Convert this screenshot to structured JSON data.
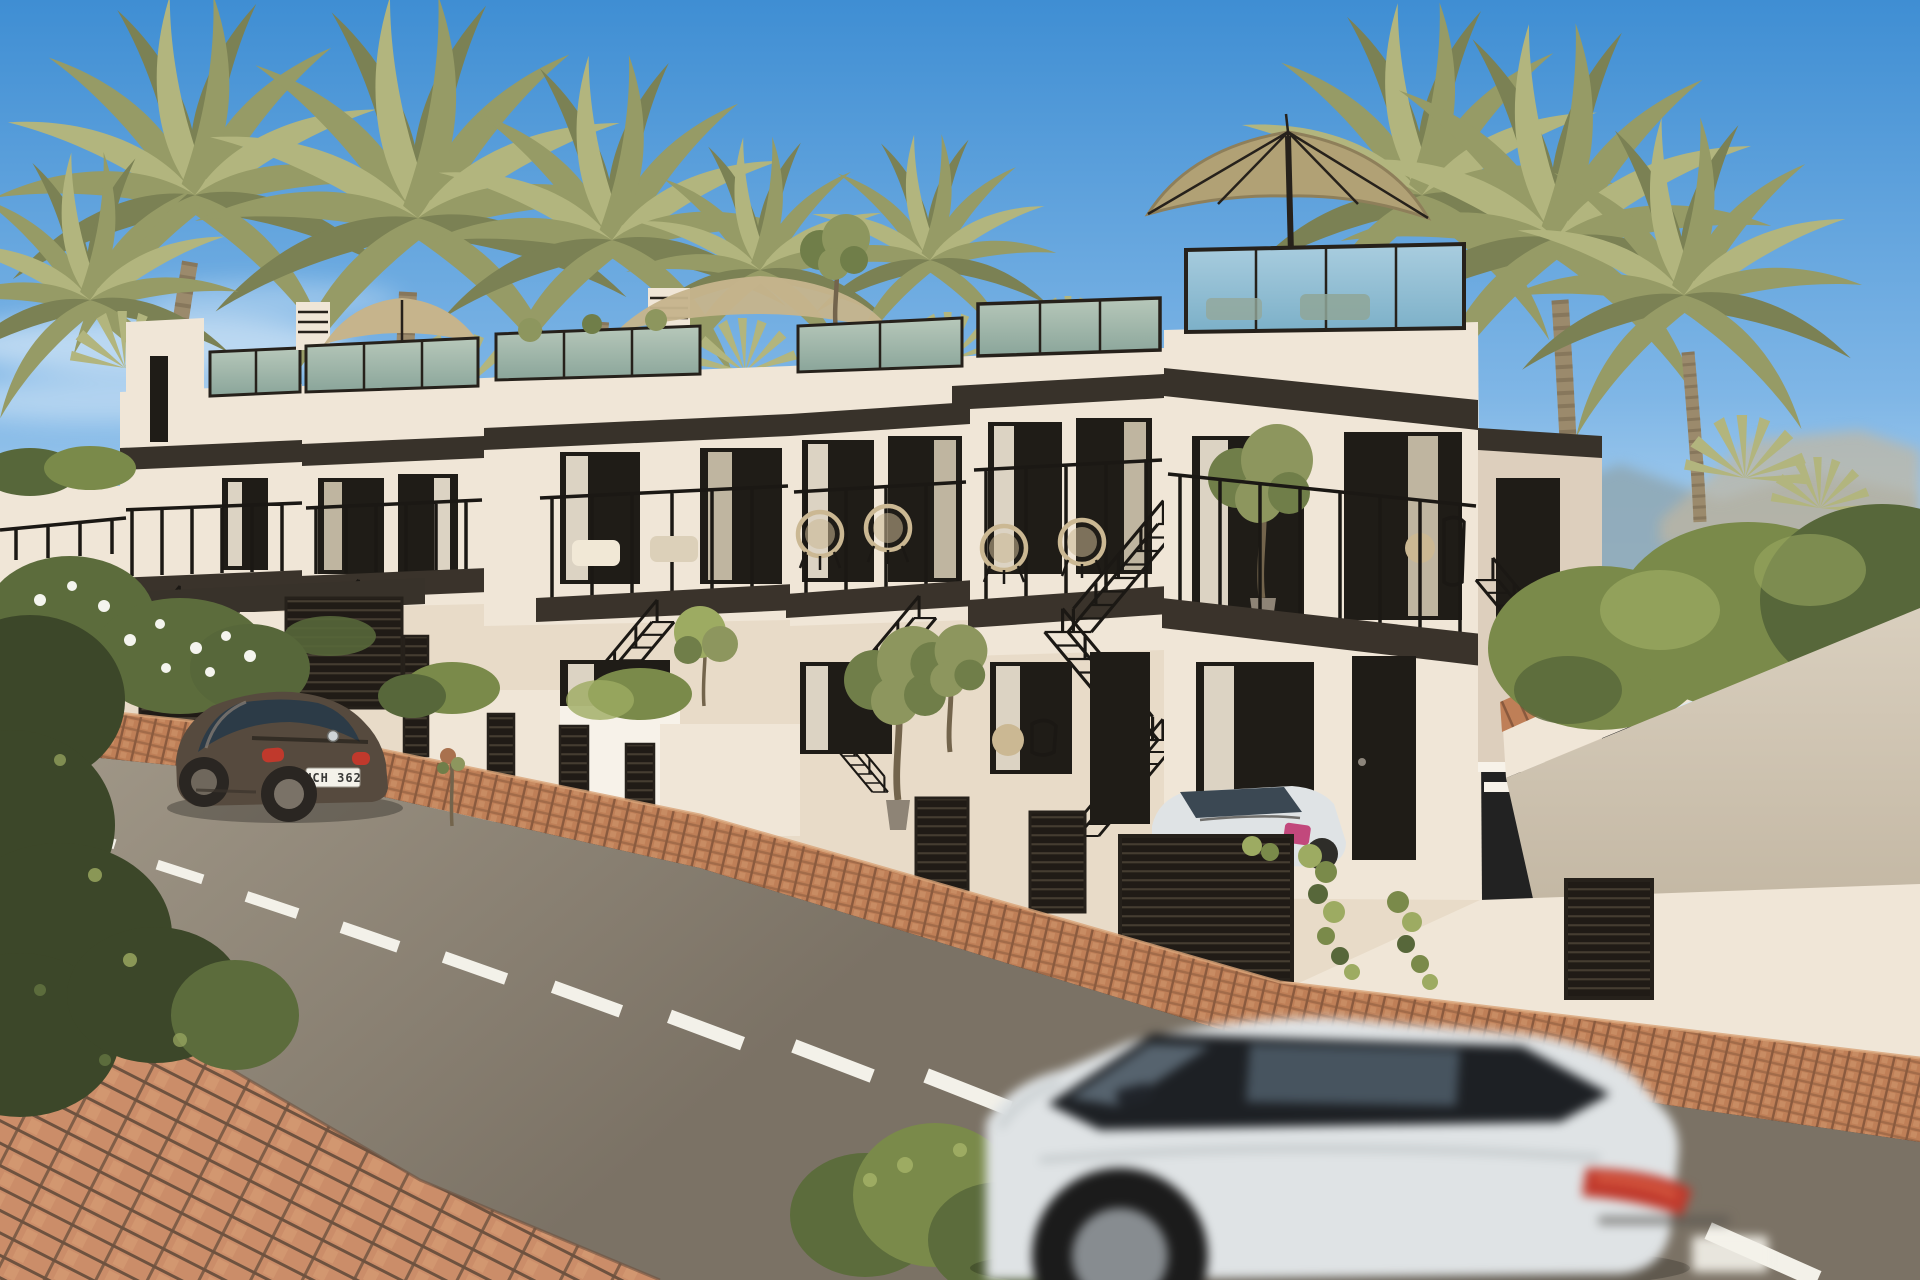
{
  "scene": {
    "type": "architectural-exterior-render",
    "description": "Sunny photorealistic CGI render of a row of six modern terraced townhouses with rooftop glass-balustrade terraces, dark fascia bands, black steel exterior stairs and balconies, on a curving asphalt street lined with palm trees. A brown coupe is parked uphill at the left, a white convertible is parked behind a dark slatted fence, and a motion-blurred white SUV drives through the foreground.",
    "setting": "coastal residential street, daytime, clear blue sky",
    "style": "photorealistic 3D visualization"
  },
  "palette": {
    "skyTop": "#3f8ed3",
    "skyMid": "#7fb6e6",
    "skyHorizon": "#d8ecf8",
    "hill": "#8fa9b6",
    "sandHill": "#c2b79f",
    "palm": "#969b66",
    "palmDark": "#7b8154",
    "palmLight": "#b2b57e",
    "trunk": "#9b8a6c",
    "trunkDark": "#73644c",
    "wall": "#f0e6d7",
    "wallShade": "#ddcfbd",
    "wallWarm": "#e8dbc8",
    "white": "#f7f2e9",
    "fascia": "#38322a",
    "frame": "#26211b",
    "rail": "#1b1814",
    "windowDark": "#1f1c17",
    "curtain": "#f1e8d6",
    "curtainShade": "#dcd0b9",
    "glassGreenTop": "#b7c8ba",
    "glassGreenBot": "#8aa59a",
    "glassSkyTop": "#a9cddf",
    "glassSkyBot": "#7cb0c8",
    "deck": "#3a332b",
    "slatBg": "#201b16",
    "slatLine": "#453d31",
    "road": "#948b7c",
    "roadFar": "#a49b8b",
    "roadNear": "#7b7265",
    "marking": "#f3f1e9",
    "kerbBrick": "#bf7f57",
    "kerbJoint": "#8a5a3e",
    "kerbLight": "#d9a478",
    "paverBrick": "#cb8d69",
    "paverJoint": "#6e523f",
    "paverLight": "#e0a87f",
    "hedge": "#7a8a4a",
    "hedgeDark": "#57673a",
    "hedgeLight": "#9dab62",
    "olive": "#8d965e",
    "oliveDark": "#707e49",
    "bushDark": "#3c4729",
    "bushMid": "#5c6c3c",
    "flowerWhite": "#f4f4ee",
    "umbrella": "#b1a175",
    "umbrellaDark": "#8e7f5a",
    "sail": "#c6b48c",
    "tanChair": "#cbb893",
    "concrete": "#d9cfbe",
    "concreteShade": "#c3b7a3",
    "potGrey": "#8e8476",
    "beetle": "#564a3e",
    "beetleDark": "#2a2622",
    "beetleGlass": "#2c3b47",
    "suv": "#dfe3e5",
    "suvGlass": "#15181c",
    "tailRed": "#c0392c",
    "plate": "#f4f2ea",
    "plateText": "#3a3a38"
  },
  "vehicles": {
    "parked_coupe": {
      "model_look": "round-back coupe",
      "color_name": "brown",
      "plate": "UCH 362"
    },
    "parked_convertible": {
      "color_name": "white",
      "detail": "blue tinted windshield, parked behind slatted fence"
    },
    "moving_suv": {
      "color_name": "white",
      "detail": "motion-blurred, black glass roofline, red taillight"
    }
  },
  "street": {
    "marking": "white dashed centre line",
    "surface": "asphalt",
    "kerb": "red brick strip",
    "sidewalk": "red brick paving"
  },
  "buildings": {
    "units": 6,
    "features": [
      "rooftop terraces with glass balustrades",
      "khaki patio umbrella on tallest roof",
      "tan shade sails over lower roofs",
      "black fire-escape style exterior stairs",
      "balconies with black metal railings",
      "dark slatted garage and vent doors",
      "white stepped planter walls with hedges",
      "potted olive trees",
      "white curtains behind dark-framed glazing"
    ]
  }
}
